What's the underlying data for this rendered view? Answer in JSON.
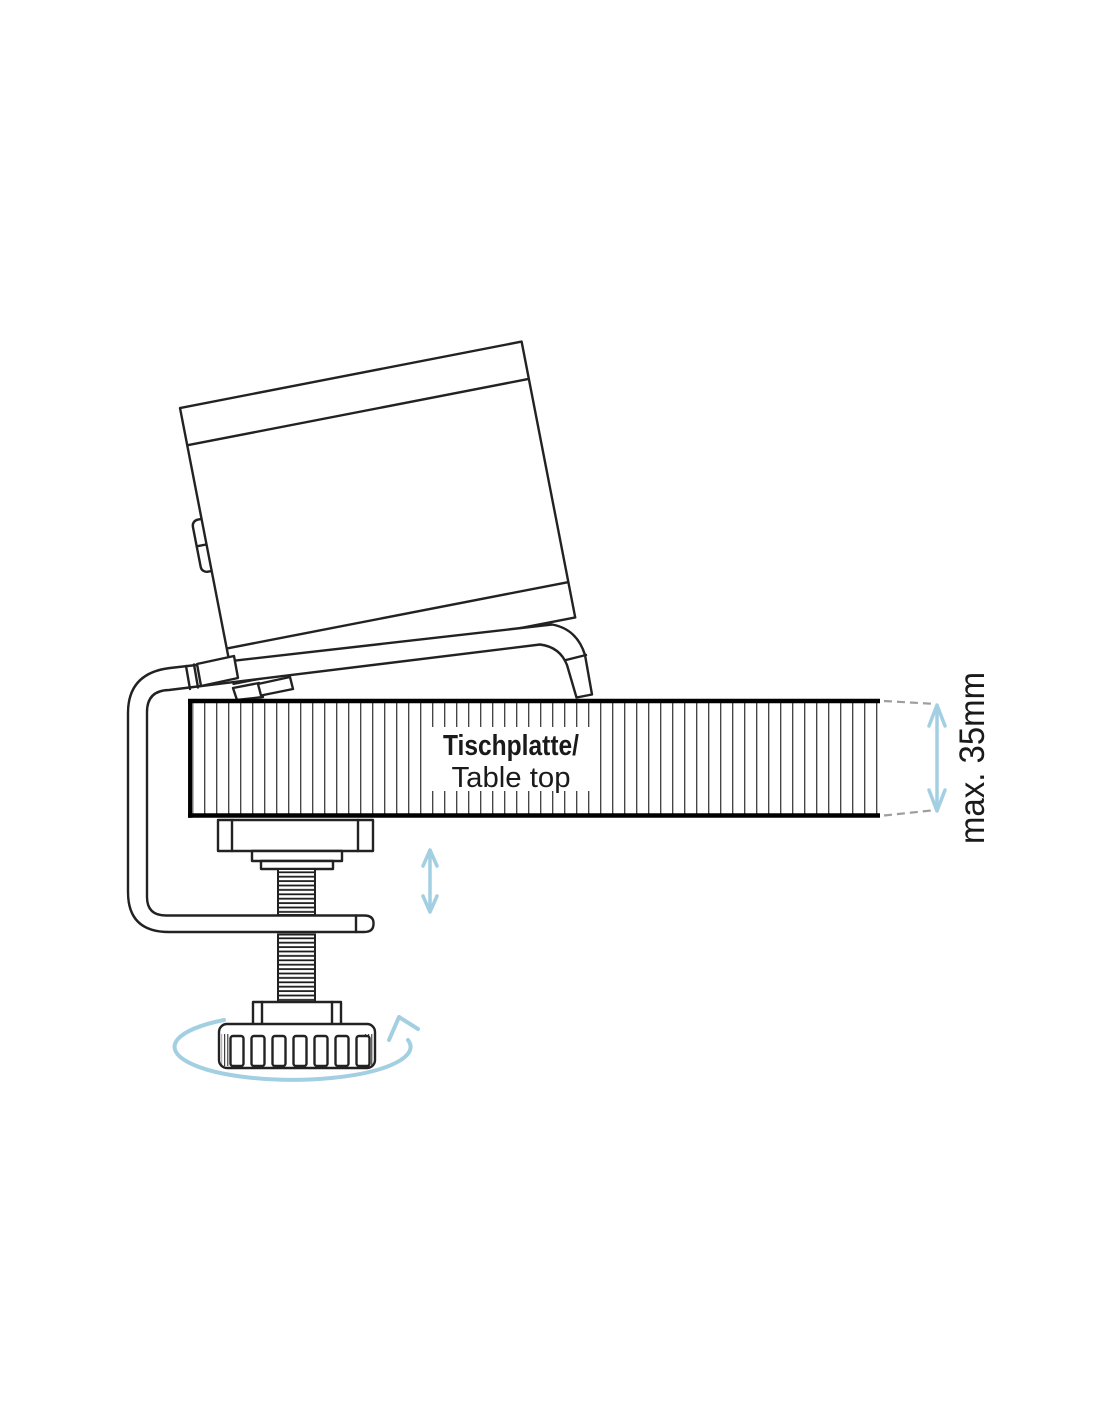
{
  "diagram": {
    "table_label": {
      "line1": "Tischplatte/",
      "line2": "Table top"
    },
    "dimension": {
      "label": "max. 35mm"
    },
    "colors": {
      "accent_blue": "#a3cfe2",
      "dash_gray": "#9e9e9e",
      "line_dark": "#222222"
    },
    "icons": {
      "rotation_arrow": "turn-knob-counterclockwise",
      "height_arrow": "vertical-adjust-double-arrow",
      "dimension_arrow": "thickness-dimension-double-arrow"
    }
  }
}
